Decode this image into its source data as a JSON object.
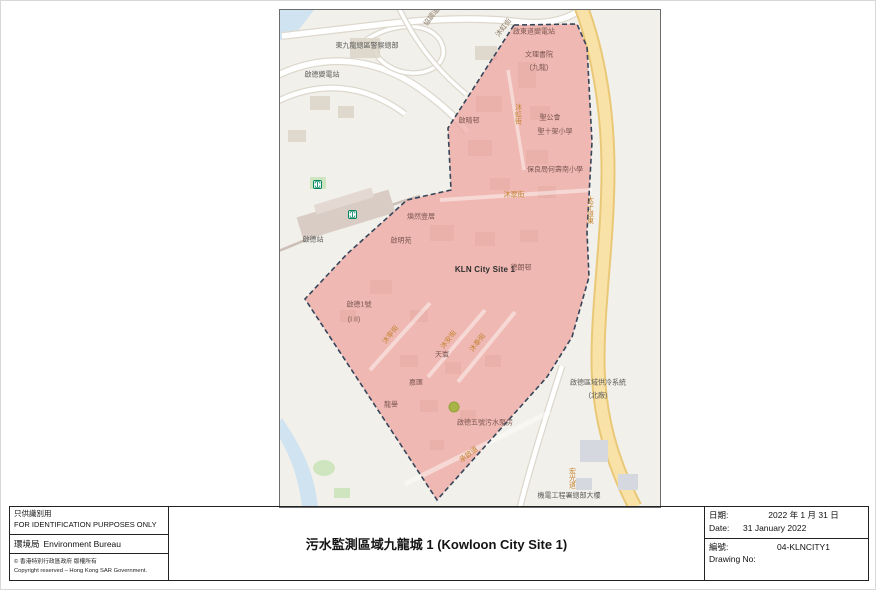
{
  "map": {
    "colors": {
      "region_fill": "#ee9d9a",
      "region_boundary": "#36455a",
      "highway": "#f9e2a8",
      "water": "#cfe3f0",
      "park_green": "#cfe5c0",
      "marker_green": "#a9b448"
    },
    "site_label": "KLN City Site 1",
    "labels": [
      {
        "name": "police-headquarters",
        "text": "東九龍總區警察總部",
        "x": 87,
        "y": 36,
        "cls": "gray"
      },
      {
        "name": "kai-tak-substation",
        "text": "啟德變電站",
        "x": 42,
        "y": 65,
        "cls": "gray"
      },
      {
        "name": "hip-tiu-road",
        "text": "協調道",
        "x": 152,
        "y": 7,
        "cls": "street-gray",
        "rot": -52
      },
      {
        "name": "muk-hung-street-top",
        "text": "沐虹街",
        "x": 224,
        "y": 18,
        "cls": "street-gray",
        "rot": -52
      },
      {
        "name": "kai-tung-road-substation",
        "text": "啟東道變電站",
        "x": 254,
        "y": 22,
        "cls": "pink"
      },
      {
        "name": "cognitio-college-line1",
        "text": "文理書院",
        "x": 259,
        "y": 45,
        "cls": "pink"
      },
      {
        "name": "cognitio-college-line2",
        "text": "(九龍)",
        "x": 259,
        "y": 58,
        "cls": "pink"
      },
      {
        "name": "kai-ching-estate",
        "text": "啟晴邨",
        "x": 189,
        "y": 111,
        "cls": "pink"
      },
      {
        "name": "muk-hung-street-vertical",
        "text": "沐虹街",
        "x": 238,
        "y": 104,
        "cls": "street-orange",
        "vertical": true
      },
      {
        "name": "skh-line1",
        "text": "聖公會",
        "x": 270,
        "y": 108,
        "cls": "pink"
      },
      {
        "name": "skh-line2",
        "text": "聖十架小學",
        "x": 275,
        "y": 122,
        "cls": "pink"
      },
      {
        "name": "plk-school",
        "text": "保良局何壽南小學",
        "x": 275,
        "y": 160,
        "cls": "pink"
      },
      {
        "name": "muk-chui-street",
        "text": "沐翠街",
        "x": 234,
        "y": 185,
        "cls": "street-orange"
      },
      {
        "name": "de-novo",
        "text": "煥然壹居",
        "x": 141,
        "y": 207,
        "cls": "pink"
      },
      {
        "name": "kai-tak-station",
        "text": "啟德站",
        "x": 33,
        "y": 230,
        "cls": "gray"
      },
      {
        "name": "kai-ming-court",
        "text": "啟明苑",
        "x": 121,
        "y": 231,
        "cls": "pink"
      },
      {
        "name": "site-name",
        "text": "KLN City Site 1",
        "x": 205,
        "y": 260,
        "cls": "site"
      },
      {
        "name": "tak-long-estate",
        "text": "德朗邨",
        "x": 241,
        "y": 258,
        "cls": "pink"
      },
      {
        "name": "one-kai-tak-line1",
        "text": "啟德1號",
        "x": 79,
        "y": 295,
        "cls": "pink"
      },
      {
        "name": "one-kai-tak-line2",
        "text": "(I II)",
        "x": 74,
        "y": 310,
        "cls": "pink"
      },
      {
        "name": "muk-ning-street",
        "text": "沐寧街",
        "x": 111,
        "y": 325,
        "cls": "street-orange",
        "rot": -52
      },
      {
        "name": "muk-on-street",
        "text": "沐安街",
        "x": 169,
        "y": 330,
        "cls": "street-orange",
        "rot": -52
      },
      {
        "name": "muk-tai-street",
        "text": "沐泰街",
        "x": 198,
        "y": 333,
        "cls": "street-orange",
        "rot": -52
      },
      {
        "name": "sky-tower",
        "text": "天寰",
        "x": 162,
        "y": 345,
        "cls": "pink"
      },
      {
        "name": "k-city",
        "text": "嘉匯",
        "x": 136,
        "y": 373,
        "cls": "pink"
      },
      {
        "name": "vibe-centro",
        "text": "龍譽",
        "x": 111,
        "y": 395,
        "cls": "pink"
      },
      {
        "name": "kai-tak-no5-sewage-pumping-station",
        "text": "啟德五號污水泵房",
        "x": 205,
        "y": 413,
        "cls": "pink"
      },
      {
        "name": "shing-kai-road",
        "text": "承啟道",
        "x": 189,
        "y": 445,
        "cls": "street-orange",
        "rot": -38
      },
      {
        "name": "district-cooling-line1",
        "text": "啟德區域供冷系統",
        "x": 318,
        "y": 373,
        "cls": "gray"
      },
      {
        "name": "district-cooling-line2",
        "text": "(北廠)",
        "x": 318,
        "y": 386,
        "cls": "gray"
      },
      {
        "name": "emsd-headquarters",
        "text": "機電工程署總部大樓",
        "x": 289,
        "y": 486,
        "cls": "gray"
      },
      {
        "name": "prince-edward-road-east",
        "text": "太子道東",
        "x": 310,
        "y": 200,
        "cls": "street-orange",
        "vertical": true
      },
      {
        "name": "wang-kwong-road",
        "text": "宏光道",
        "x": 292,
        "y": 468,
        "cls": "street-orange",
        "vertical": true
      }
    ]
  },
  "title_block": {
    "restriction_zh": "只供識別用",
    "restriction_en": "FOR IDENTIFICATION PURPOSES ONLY",
    "bureau_zh": "環境局",
    "bureau_en": "Environment Bureau",
    "copyright_zh": "© 香港特別行政區政府  版權所有",
    "copyright_en": "Copyright reserved – Hong Kong SAR Government.",
    "title": "污水監測區域九龍城 1 (Kowloon City Site 1)",
    "date_label_zh": "日期:",
    "date_value_zh": "2022 年 1 月 31 日",
    "date_label_en": "Date:",
    "date_value_en": "31 January 2022",
    "number_label_zh": "編號:",
    "number_value": "04-KLNCITY1",
    "drawing_label_en": "Drawing No:"
  }
}
